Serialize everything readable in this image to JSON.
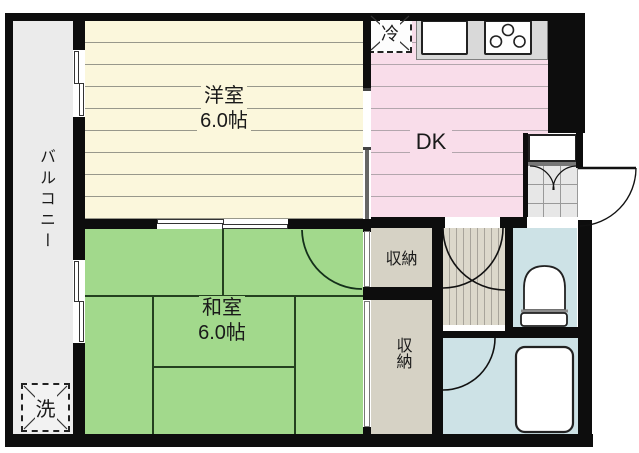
{
  "floorplan": {
    "balcony": {
      "label": "バルコニー",
      "laundry_label": "洗"
    },
    "western_room": {
      "name": "洋室",
      "size": "6.0帖"
    },
    "dining_kitchen": {
      "label": "DK",
      "fridge_label": "冷"
    },
    "japanese_room": {
      "name": "和室",
      "size": "6.0帖"
    },
    "closet_upper": {
      "label": "収納"
    },
    "closet_lower": {
      "label": "収納"
    }
  },
  "colors": {
    "wall": "#0d0d0d",
    "western_room": "#fbf7dc",
    "dk": "#f9ddea",
    "japanese_room": "#a2d98c",
    "closet": "#d6d2c5",
    "wet": "#cde2e6",
    "balcony": "#ebebeb",
    "hallway": "#dcd8cb"
  }
}
